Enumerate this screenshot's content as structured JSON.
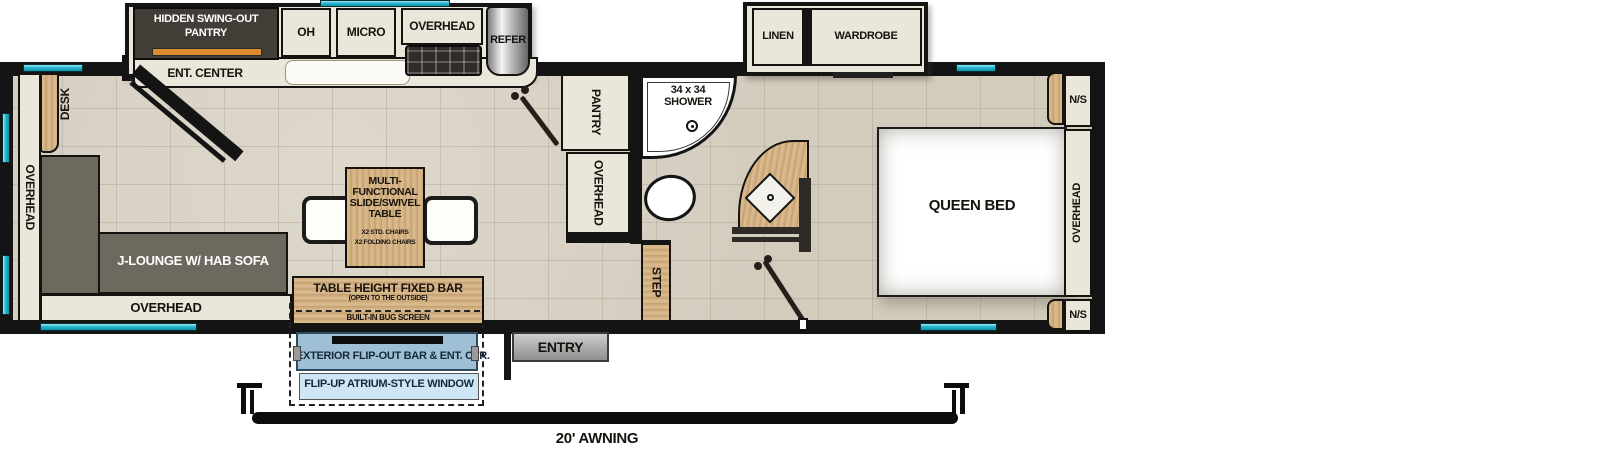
{
  "plan": {
    "kitchen_slide": {
      "hidden_pantry_l1": "HIDDEN SWING-OUT",
      "hidden_pantry_l2": "PANTRY",
      "oh": "OH",
      "micro": "MICRO",
      "overhead": "OVERHEAD",
      "refer": "REFER",
      "ent_center": "ENT. CENTER"
    },
    "living": {
      "desk": "DESK",
      "overhead_left": "OVERHEAD",
      "sofa": "J-LOUNGE W/ HAB SOFA",
      "overhead_bottom": "OVERHEAD",
      "table_l1": "MULTI-",
      "table_l2": "FUNCTIONAL",
      "table_l3": "SLIDE/SWIVEL",
      "table_l4": "TABLE",
      "table_s1": "X2 STD. CHAIRS",
      "table_s2": "X2 FOLDING CHAIRS"
    },
    "bar_area": {
      "fixed_bar": "TABLE HEIGHT FIXED BAR",
      "fixed_bar_sub": "(OPEN TO THE OUTSIDE)",
      "bug_screen": "BUILT-IN BUG SCREEN",
      "exterior_bar": "EXTERIOR FLIP-OUT BAR & ENT. CTR.",
      "atrium_window": "FLIP-UP ATRIUM-STYLE WINDOW"
    },
    "entry": "ENTRY",
    "awning": "20' AWNING",
    "mid": {
      "pantry": "PANTRY",
      "overhead": "OVERHEAD",
      "step": "STEP"
    },
    "bath": {
      "shower_l1": "34 x 34",
      "shower_l2": "SHOWER"
    },
    "bedroom": {
      "linen": "LINEN",
      "wardrobe": "WARDROBE",
      "queen_bed": "QUEEN BED",
      "ns_top": "N/S",
      "overhead_right": "OVERHEAD",
      "ns_bottom": "N/S"
    }
  },
  "colors": {
    "wall": "#141414",
    "floor": "#d3cbbc",
    "cabinet": "#eae6da",
    "wood": "#d3b184",
    "sofa": "#6e695f",
    "window_teal": "#27b7cd",
    "pantry_dark": "#423d36",
    "pantry_orange": "#dd8c2e",
    "exterior_bar_blue": "#9fc0d4",
    "atrium_blue": "#cfe6f4"
  }
}
